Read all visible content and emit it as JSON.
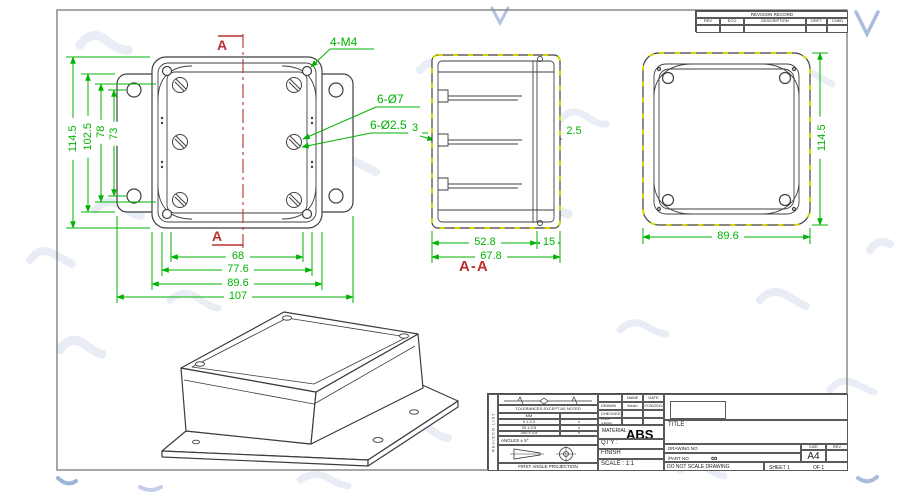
{
  "front_view": {
    "callout_corner_screws": "4-M4",
    "callout_flange_holes": "6-Ø7",
    "callout_boss_holes": "6-Ø2.5",
    "section_letter_top": "A",
    "section_letter_bottom": "A",
    "dim_height_overall": "114.5",
    "dim_height_flange": "102.5",
    "dim_height_inner": "78",
    "dim_hole_spacing_v": "73",
    "dim_width_inner": "68",
    "dim_width_mid": "77.6",
    "dim_width_box": "89.6",
    "dim_width_flange": "107"
  },
  "section_view": {
    "label": "A-A",
    "dim_left_wall": "3",
    "dim_right_wall": "2.5",
    "dim_inner_width": "52.8",
    "dim_flange": "15",
    "dim_total": "67.8"
  },
  "right_view": {
    "dim_height": "114.5",
    "dim_width": "89.6"
  },
  "revision_table": {
    "title": "REVISION RECORD",
    "col_rev": "REV",
    "col_eco": "ECO",
    "col_description": "DESCRIPTION",
    "col_drft": "DRFT",
    "col_chkd": "CHKD"
  },
  "title_block": {
    "side_label": "REV/ECO LIST",
    "tolerance_note": "TOLERANCES EXCEPT AS NOTED",
    "tolerance_unit": "MM",
    "tolerance_rows": [
      "0 ± 0.3",
      "20 ± 0.5",
      "200 ± 0.8"
    ],
    "tolerance_dot": "±",
    "angles": "ANGLES ± 5°",
    "projection": "FIRST ANGLE PROJECTION",
    "name_header": "NAME",
    "date_header": "DATE",
    "drawn_label": "DRAWN",
    "drawn_name": "Kevin",
    "drawn_date": "07/30/2015",
    "checked_label": "CHECKED",
    "eng_appr_label": "ENG APPR",
    "material_label": "MATERIAL :",
    "material_value": "ABS",
    "qty_label": "QT'Y :",
    "finish_label": "FINISH",
    "scale_label": "SCALE : 1:1",
    "title_label": "TITLE",
    "drawing_no_label": "DRAWING NO",
    "part_no_label": "/PART  NO",
    "part_no_value": "∞",
    "size_label": "SIZE",
    "size_value": "A4",
    "rev_label": "REV",
    "note": "DO NOT SCALE DRAWING",
    "sheet_label": "SHEET 1",
    "of_label": "OF 1"
  }
}
